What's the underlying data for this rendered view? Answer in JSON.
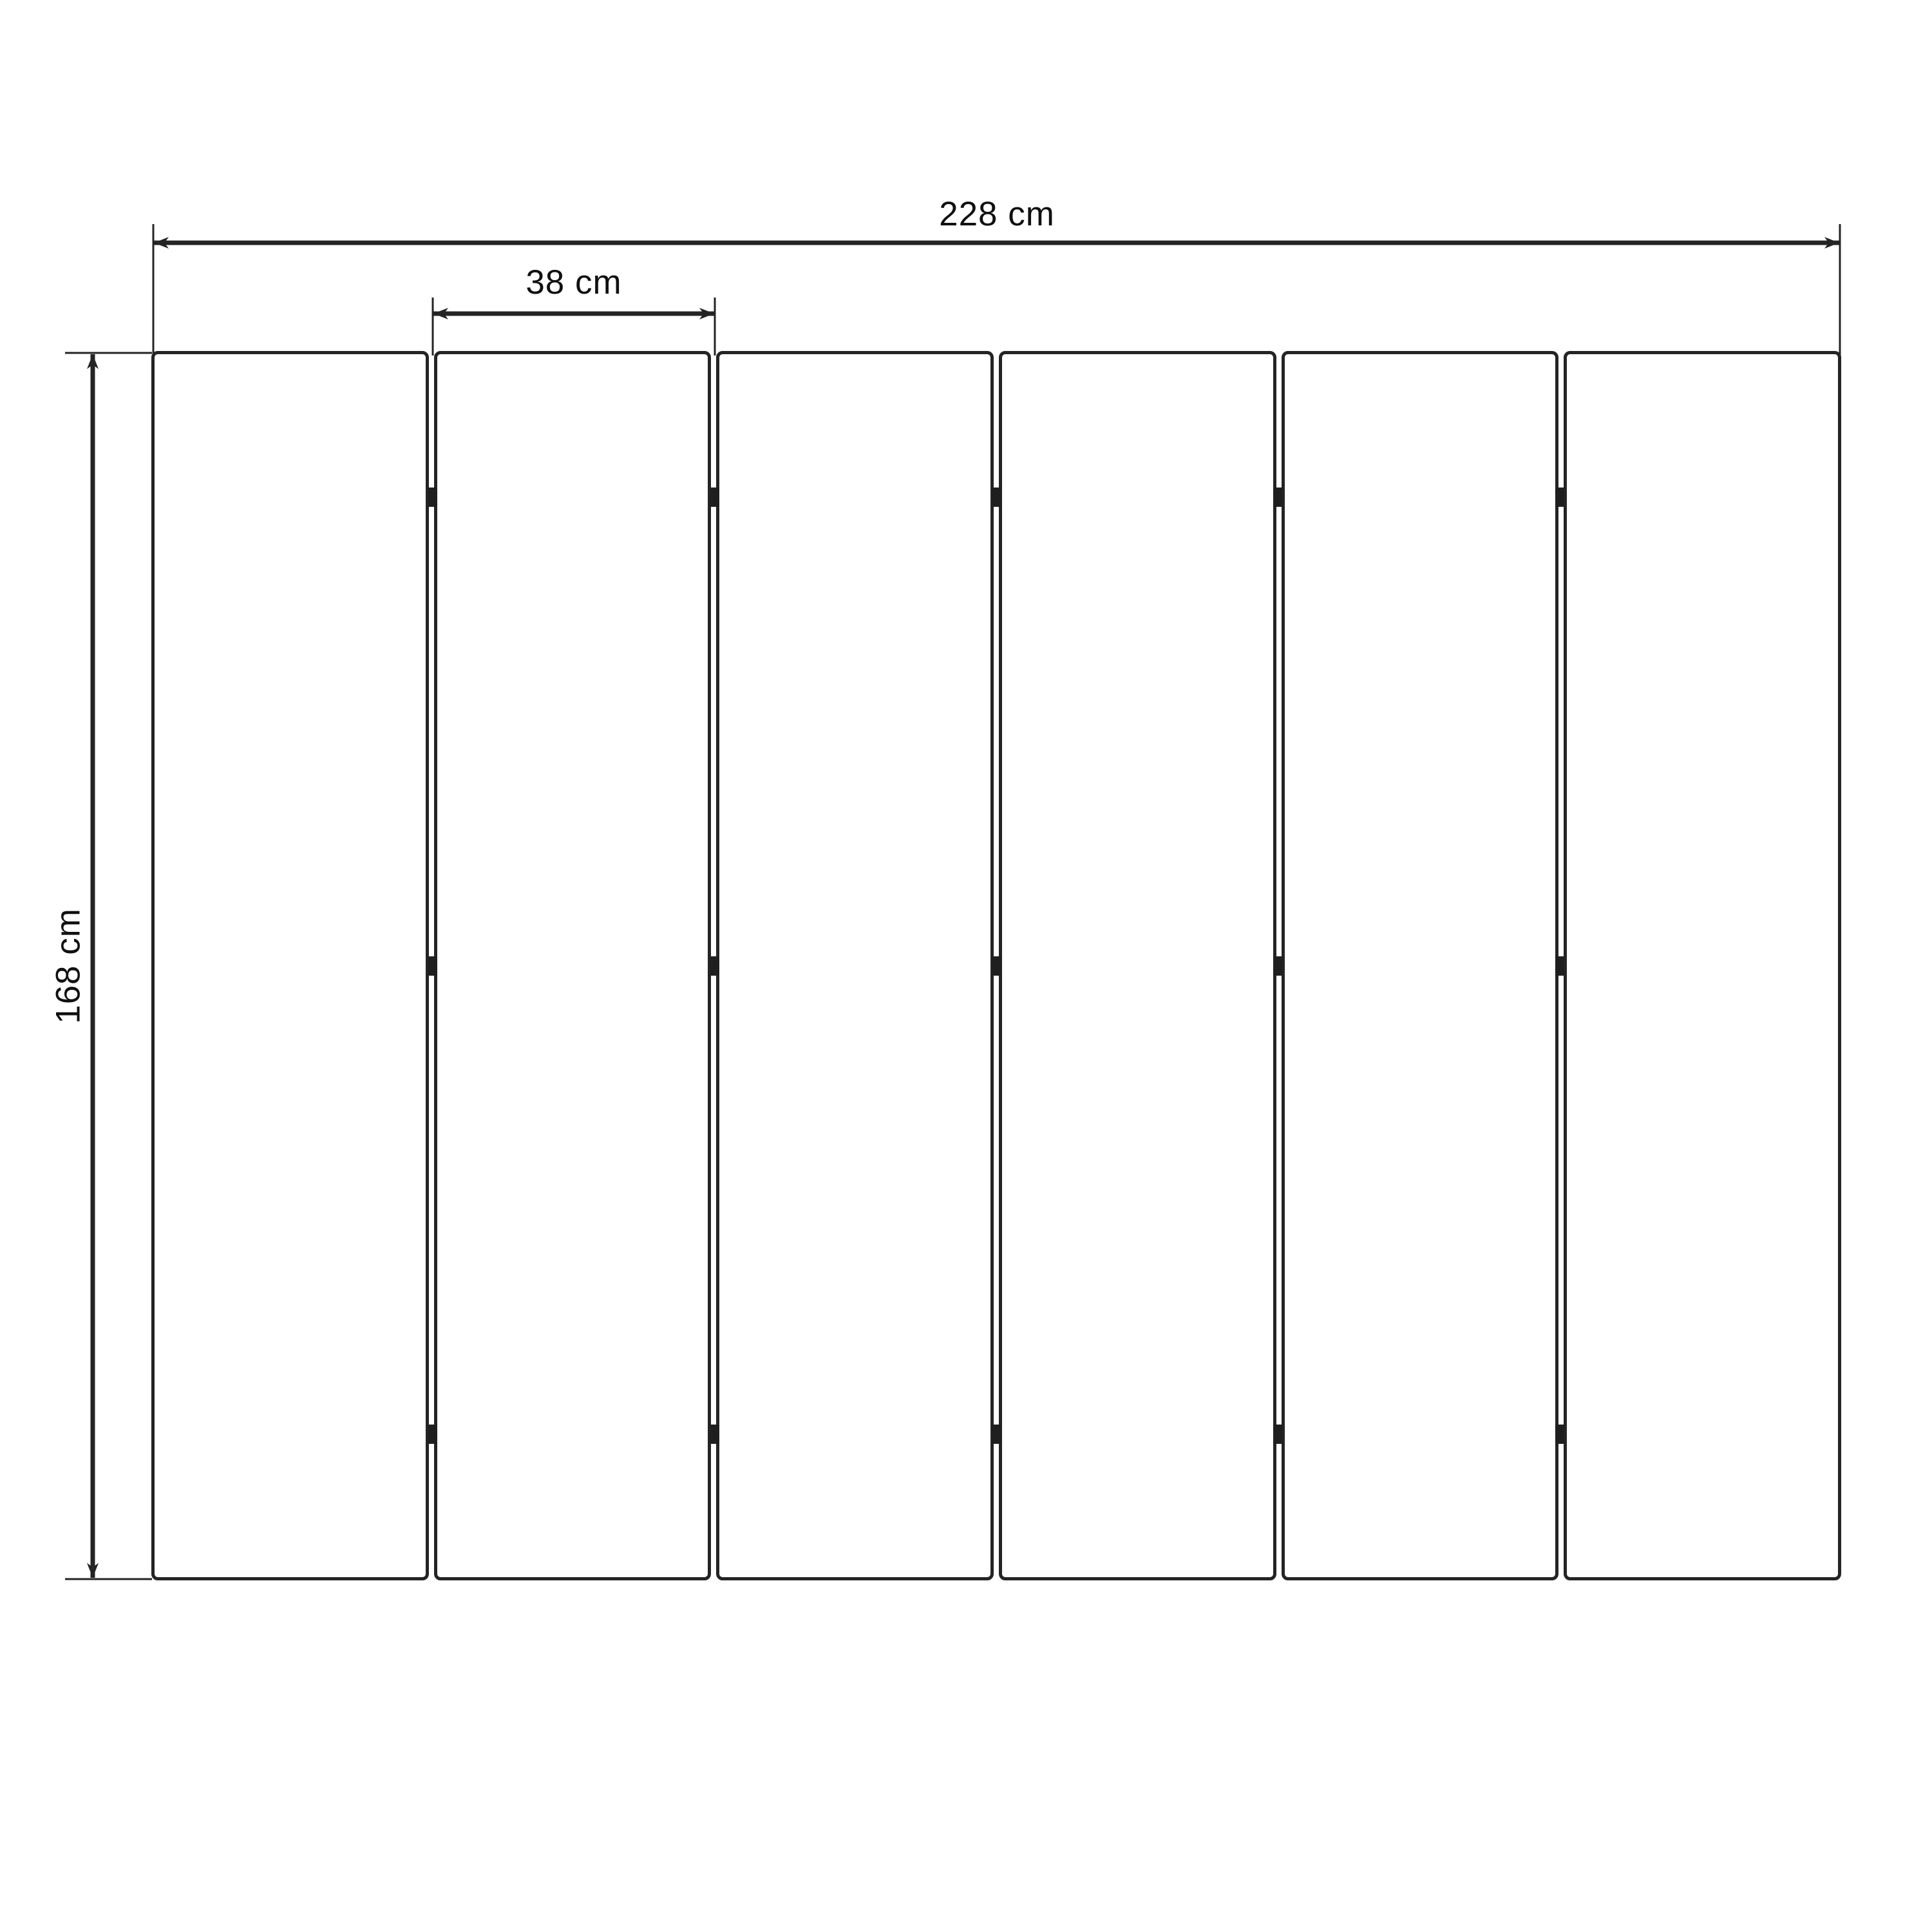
{
  "diagram": {
    "type": "dimension-drawing",
    "subject": "six-panel folding screen, front elevation",
    "dimensions": {
      "total_width": {
        "label": "228 cm",
        "value": 228,
        "unit": "cm"
      },
      "panel_width": {
        "label": "38 cm",
        "value": 38,
        "unit": "cm"
      },
      "height": {
        "label": "168 cm",
        "value": 168,
        "unit": "cm"
      }
    },
    "panels": {
      "count": 6,
      "joints": 5,
      "hinges_per_joint": 3
    },
    "colors": {
      "line": "#242424",
      "hinge": "#1f1f1f",
      "text": "#101010",
      "background": "#ffffff"
    }
  }
}
